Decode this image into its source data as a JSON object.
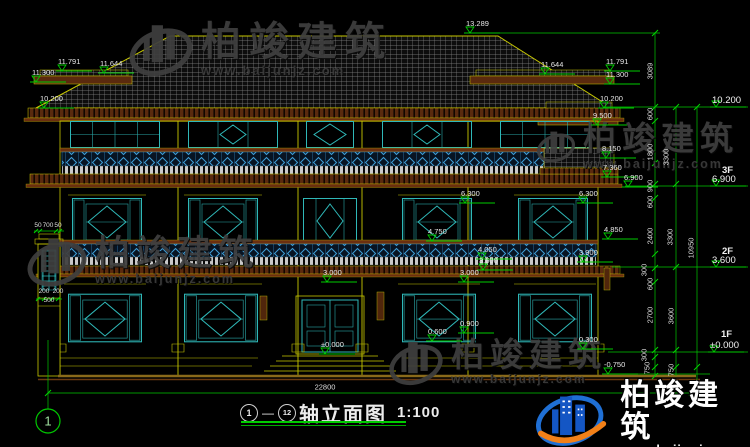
{
  "colors": {
    "background": "#000000",
    "line_green": "#00c800",
    "line_yellow": "#c8c800",
    "line_cyan": "#2fb8b8",
    "cornice_brown": "#5a2a0e",
    "text_white": "#e8e8e8",
    "logo_blue": "#1456c4",
    "logo_orange": "#f28018"
  },
  "title_block": {
    "axis_from": "1",
    "dash": "—",
    "axis_to": "12",
    "name": "轴立面图",
    "scale": "1:100"
  },
  "axis_bubble": "1",
  "watermark": {
    "brand": "柏竣建筑",
    "url": "www.baijunjz.com"
  },
  "logo": {
    "brand": "柏竣建筑",
    "url": "www.baijunjz.com"
  },
  "elevation_markers": [
    {
      "text": "13.289",
      "x": 470,
      "y": 33
    },
    {
      "text": "11.300",
      "x": 36,
      "y": 82
    },
    {
      "text": "11.791",
      "x": 62,
      "y": 71
    },
    {
      "text": "11.644",
      "x": 104,
      "y": 73
    },
    {
      "text": "10.200",
      "x": 44,
      "y": 108
    },
    {
      "text": "11.644",
      "x": 545,
      "y": 74
    },
    {
      "text": "11.791",
      "x": 610,
      "y": 71
    },
    {
      "text": "11.300",
      "x": 610,
      "y": 84
    },
    {
      "text": "10.200",
      "x": 604,
      "y": 108
    },
    {
      "text": "9.500",
      "x": 597,
      "y": 125
    },
    {
      "text": "8.150",
      "x": 606,
      "y": 158
    },
    {
      "text": "7.360",
      "x": 607,
      "y": 177
    },
    {
      "text": "6.900",
      "x": 628,
      "y": 187
    },
    {
      "text": "6.300",
      "x": 583,
      "y": 203
    },
    {
      "text": "4.850",
      "x": 608,
      "y": 239
    },
    {
      "text": "3.900",
      "x": 583,
      "y": 262
    },
    {
      "text": "6.300",
      "x": 465,
      "y": 203
    },
    {
      "text": "4.750",
      "x": 432,
      "y": 241
    },
    {
      "text": "4.050",
      "x": 482,
      "y": 259
    },
    {
      "text": "3.600",
      "x": 483,
      "y": 270
    },
    {
      "text": "3.000",
      "x": 327,
      "y": 282
    },
    {
      "text": "3.000",
      "x": 464,
      "y": 282
    },
    {
      "text": "±0.000",
      "x": 325,
      "y": 354
    },
    {
      "text": "0.600",
      "x": 432,
      "y": 341
    },
    {
      "text": "0.900",
      "x": 464,
      "y": 333
    },
    {
      "text": "0.300",
      "x": 583,
      "y": 349
    },
    {
      "text": "-0.750",
      "x": 608,
      "y": 374
    },
    {
      "text": "10.200",
      "x": 716,
      "y": 107,
      "big": true
    },
    {
      "text": "6.900",
      "x": 716,
      "y": 186,
      "big": true
    },
    {
      "text": "3.600",
      "x": 716,
      "y": 267,
      "big": true
    },
    {
      "text": "±0.000",
      "x": 714,
      "y": 352,
      "big": true
    }
  ],
  "floor_tags": [
    {
      "text": "3F",
      "x": 722,
      "y": 166
    },
    {
      "text": "2F",
      "x": 722,
      "y": 247
    },
    {
      "text": "1F",
      "x": 721,
      "y": 330
    }
  ],
  "dimensions": [
    {
      "text": "3089",
      "x": 650,
      "y": 71,
      "rot": true
    },
    {
      "text": "600",
      "x": 650,
      "y": 114,
      "rot": true
    },
    {
      "text": "1800",
      "x": 650,
      "y": 152,
      "rot": true
    },
    {
      "text": "900",
      "x": 650,
      "y": 186,
      "rot": true
    },
    {
      "text": "600",
      "x": 650,
      "y": 202,
      "rot": true
    },
    {
      "text": "2400",
      "x": 650,
      "y": 236,
      "rot": true
    },
    {
      "text": "300",
      "x": 644,
      "y": 270,
      "rot": true
    },
    {
      "text": "600",
      "x": 650,
      "y": 284,
      "rot": true
    },
    {
      "text": "2700",
      "x": 650,
      "y": 315,
      "rot": true
    },
    {
      "text": "300",
      "x": 644,
      "y": 355,
      "rot": true
    },
    {
      "text": "750",
      "x": 647,
      "y": 368,
      "rot": true
    },
    {
      "text": "3300",
      "x": 666,
      "y": 157,
      "rot": true
    },
    {
      "text": "3300",
      "x": 670,
      "y": 237,
      "rot": true
    },
    {
      "text": "3600",
      "x": 671,
      "y": 316,
      "rot": true
    },
    {
      "text": "750",
      "x": 671,
      "y": 370,
      "rot": true
    },
    {
      "text": "10950",
      "x": 691,
      "y": 248,
      "rot": true
    },
    {
      "text": "22800",
      "x": 325,
      "y": 387
    },
    {
      "text": "50",
      "x": 38,
      "y": 226,
      "s": 6.5
    },
    {
      "text": "700",
      "x": 48,
      "y": 226,
      "s": 6.5
    },
    {
      "text": "50",
      "x": 58,
      "y": 226,
      "s": 6.5
    },
    {
      "text": "200",
      "x": 44,
      "y": 292,
      "s": 6.5
    },
    {
      "text": "200",
      "x": 58,
      "y": 292,
      "s": 6.5
    },
    {
      "text": "500",
      "x": 49,
      "y": 301,
      "s": 6.5
    }
  ]
}
